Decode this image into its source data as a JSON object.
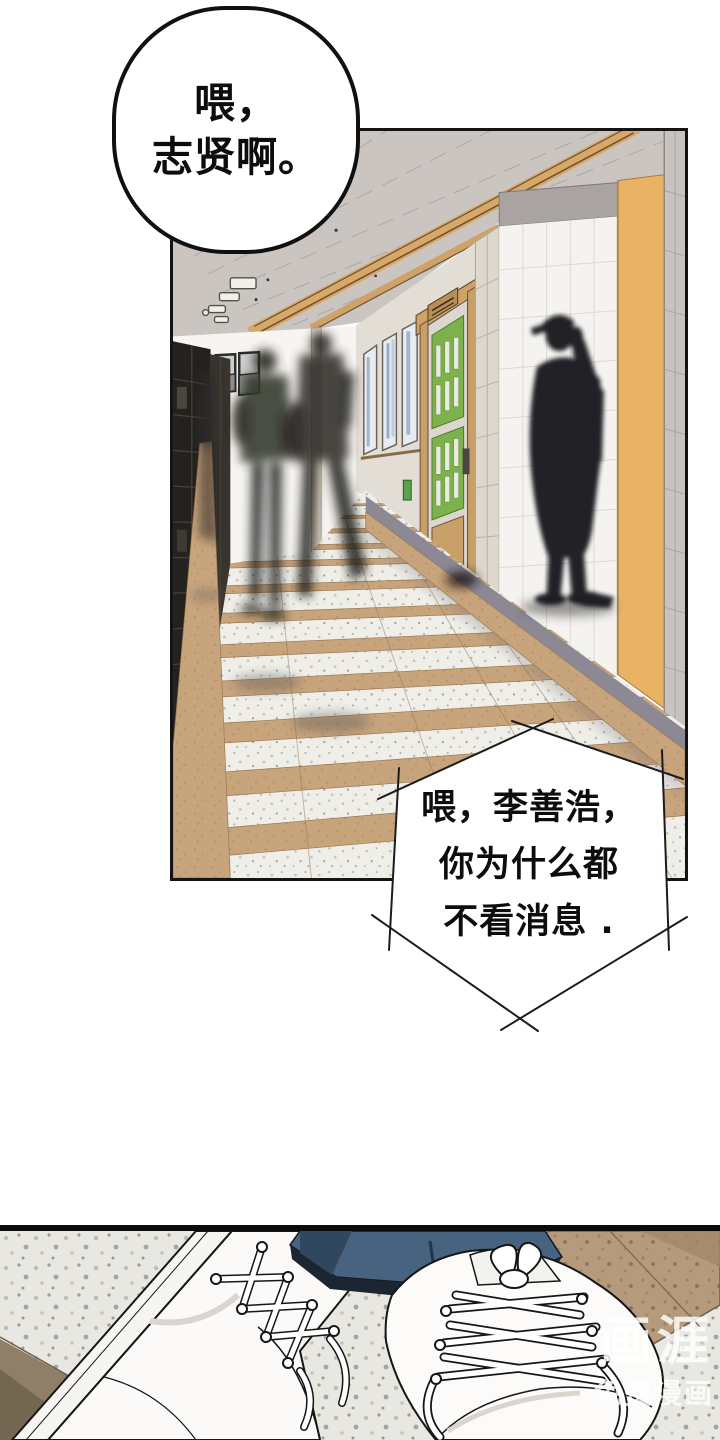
{
  "page": {
    "background": "#ffffff"
  },
  "speech_bubble_round": {
    "line1": "喂，",
    "line2": "志贤啊。"
  },
  "speech_bubble_hex": {
    "line1": "喂，李善浩，",
    "line2": "你为什么都",
    "line3": "不看消息 ."
  },
  "watermark": {
    "brand": "画涯",
    "tagline": "免费漫画"
  },
  "colors": {
    "ink": "#141414",
    "ceiling_gray": "#cbc5c2",
    "wood_beam": "#d8a868",
    "door_green": "#7cb14c",
    "pillar_orange": "#e9b366",
    "floor_tan": "#c7a47c",
    "terrazzo_white": "#efeee8",
    "locker_dark": "#24221f",
    "pants_navy": "#48637f",
    "silhouette": "#17171a",
    "watermark_white": "rgba(255,255,255,0.8)"
  }
}
